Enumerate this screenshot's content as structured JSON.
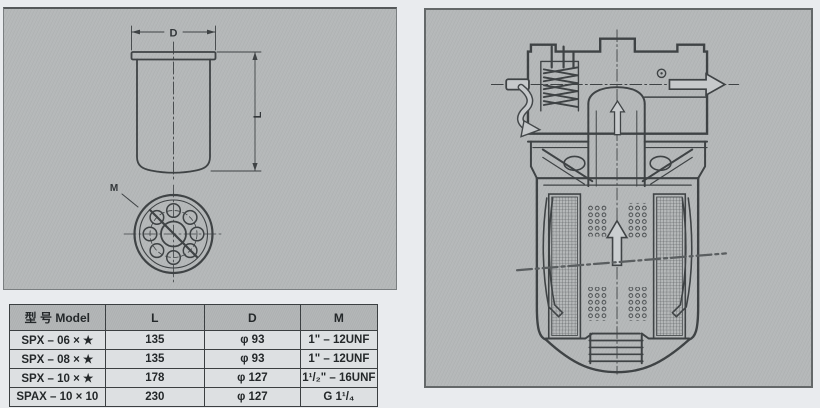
{
  "colors": {
    "page_bg": "#e9ebee",
    "panel_bg": "#b6b9ba",
    "drawing_line": "#3f4345",
    "table_header_bg": "#b3b6b7",
    "table_body_bg": "#dde0e2",
    "table_border": "#3b3f41"
  },
  "left_panel": {
    "front_view": {
      "diameter_label": "D",
      "length_label": "L"
    },
    "bottom_view": {
      "thread_label": "M"
    }
  },
  "table": {
    "headers": [
      "型 号 Model",
      "L",
      "D",
      "M"
    ],
    "rows": [
      [
        "SPX – 06 × ★",
        "135",
        "φ 93",
        "1\" – 12UNF"
      ],
      [
        "SPX – 08 × ★",
        "135",
        "φ 93",
        "1\" – 12UNF"
      ],
      [
        "SPX – 10 × ★",
        "178",
        "φ 127",
        "1¹/₂\" – 16UNF"
      ],
      [
        "SPAX – 10 × 10",
        "230",
        "φ 127",
        "G 1¹/₄"
      ]
    ]
  }
}
